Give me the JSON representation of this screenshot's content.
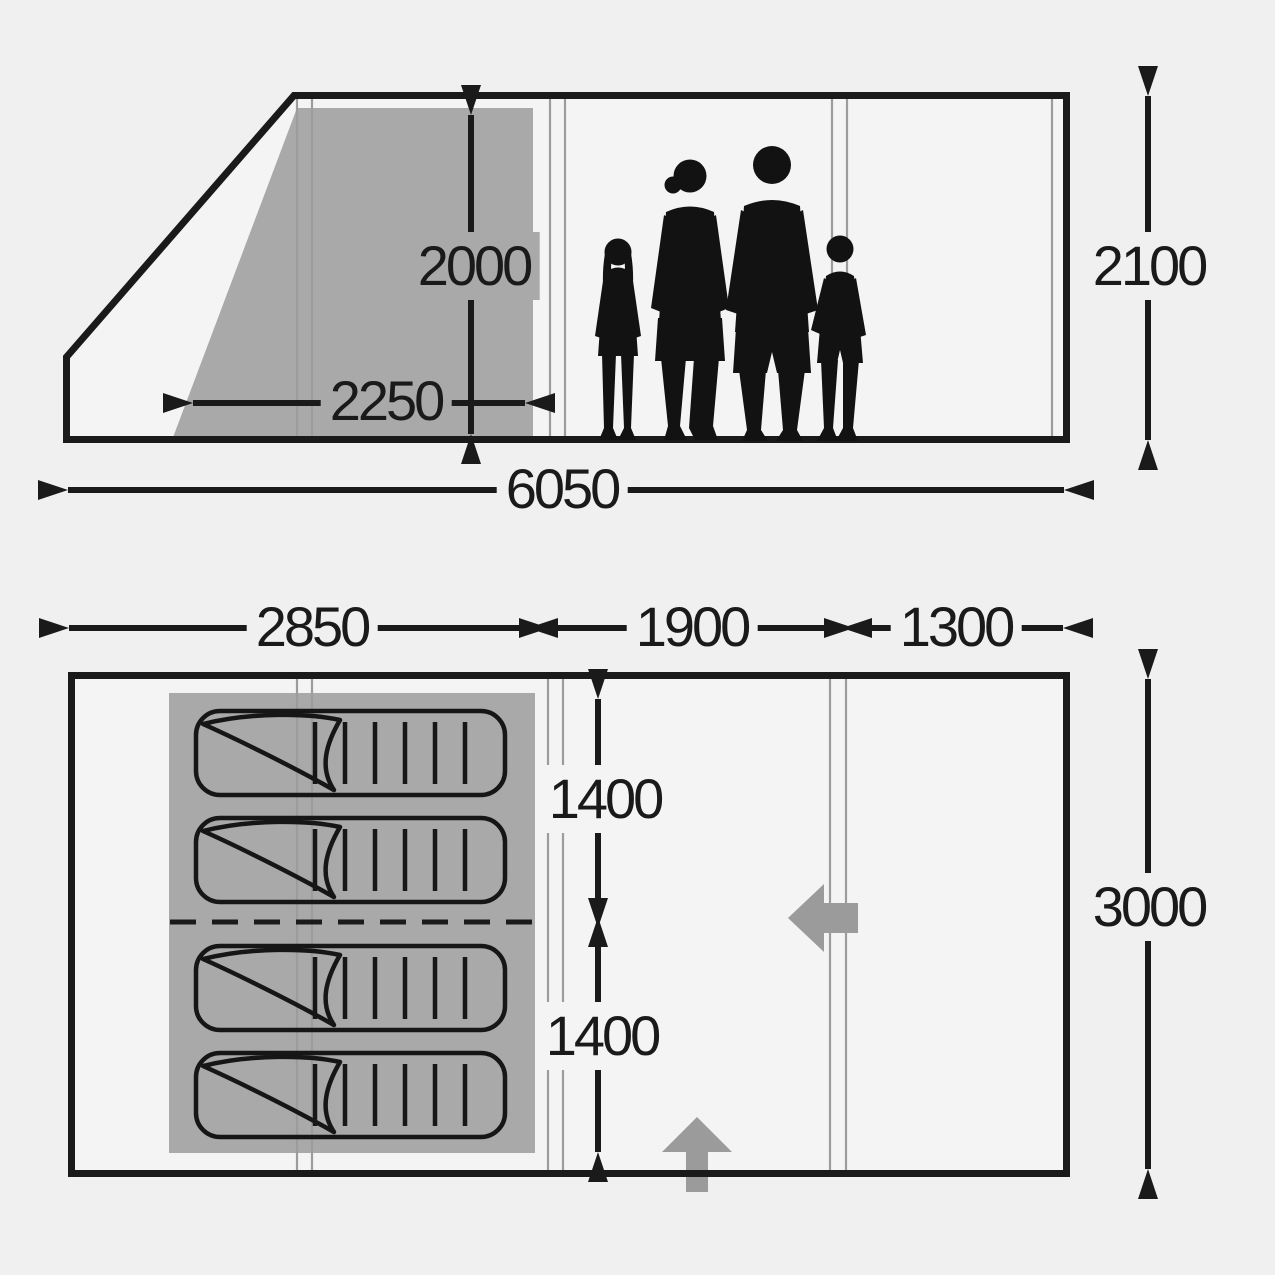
{
  "diagram_title": "tent-dimensions-diagram",
  "side_view": {
    "dims": {
      "inner_height": "2000",
      "inner_width": "2250",
      "total_length": "6050",
      "standing_height": "2100"
    }
  },
  "floor_plan": {
    "dims": {
      "bedroom_section_length": "2850",
      "living_section_length": "1900",
      "porch_section_length": "1300",
      "sleeping_cabin_depth_front": "1400",
      "sleeping_cabin_depth_rear": "1400",
      "total_width": "3000"
    },
    "sleeping_bag_count": 4
  },
  "icons": {
    "family": "family-silhouette-icon",
    "sleeping_bag": "sleeping-bag-icon",
    "side_door": "side-door-arrow-icon",
    "front_door": "front-door-arrow-icon"
  },
  "colors": {
    "background": "#f0f0f0",
    "interior": "#f4f4f4",
    "outline": "#1a1a1a",
    "inner_tent_shade": "#a9a9a9",
    "seam_line": "#9c9c9c",
    "door_arrow": "#9b9b9b",
    "silhouette": "#121212"
  }
}
